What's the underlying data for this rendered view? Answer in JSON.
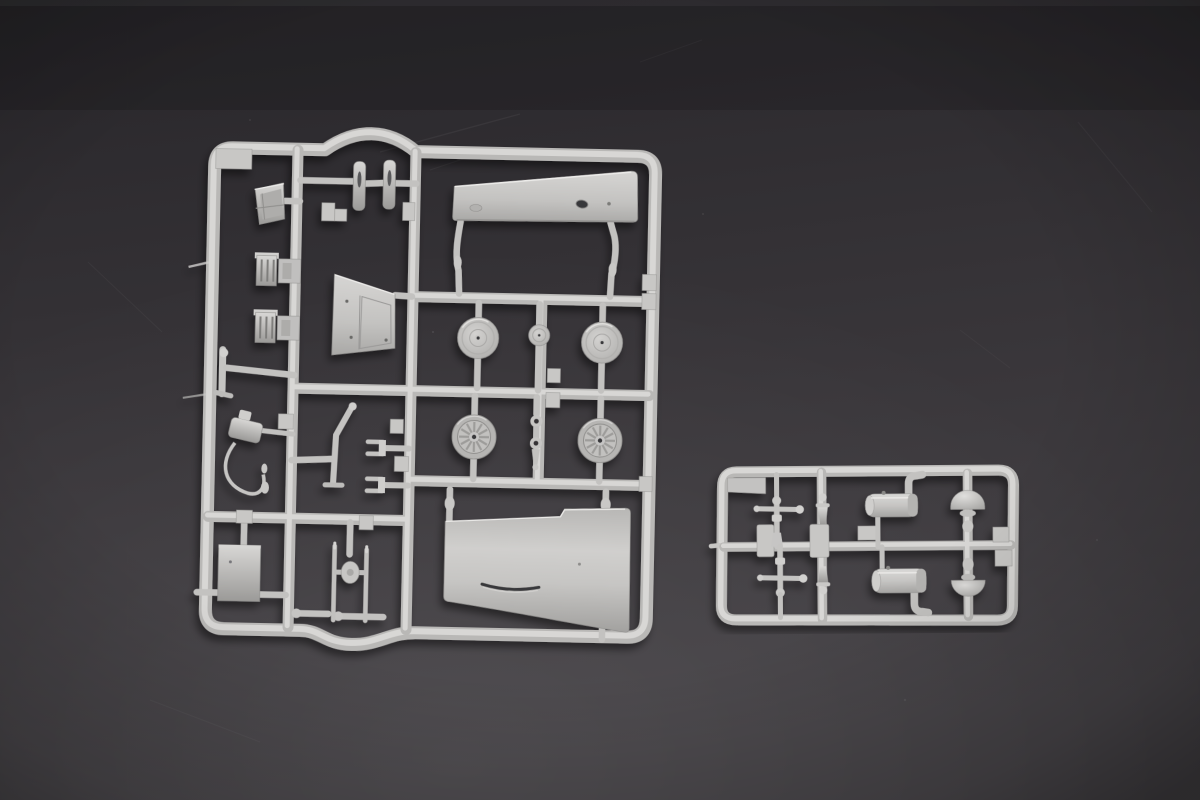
{
  "scene": {
    "description": "Overhead product photograph of two light-gray injection-molded plastic model kit sprues (parts trees) lying on a dark charcoal slate surface. The large left sprue holds two fuselage halves, four wheels, a tail wheel, a windscreen, brackets, struts and small fittings. The small right sprue holds control yokes, spindles, two exhaust cylinders and two dome-shaped parts.",
    "style": "product-photo",
    "background": "dark charcoal surface with faint scratches and soft vignette"
  },
  "colors": {
    "bg-top": "#28262a",
    "bg-bottom": "#454246",
    "plastic-base": "#c2c1bf",
    "plastic-light": "#d8d7d5",
    "plastic-highlight": "#ecebe9",
    "plastic-shadow": "#9b9a98",
    "rail-base": "#b9b8b6",
    "tab-fill": "#c8c7c5",
    "hole-dark": "#39383a"
  },
  "sprues": [
    {
      "id": "main-sprue",
      "position": "left",
      "parts": [
        "upper-fuselage-half",
        "lower-fuselage-half",
        "wheel-disc-left",
        "wheel-disc-right",
        "tail-wheel",
        "spoked-wheel-left",
        "spoked-wheel-right",
        "windscreen",
        "bracket-1",
        "bracket-2",
        "t-lever",
        "hand-pump-with-hose",
        "bulkhead-panel",
        "angled-strut",
        "fork-end-1",
        "fork-end-2",
        "chain-links",
        "equipment-box",
        "landing-gear-strut",
        "blade-1",
        "blade-2",
        "number-tabs"
      ]
    },
    {
      "id": "small-sprue",
      "position": "right",
      "parts": [
        "corner-plate",
        "control-yoke-1",
        "control-yoke-2",
        "spindle-1",
        "spindle-2",
        "exhaust-cylinder-1",
        "exhaust-cylinder-2",
        "dome-1",
        "dome-2",
        "number-tabs"
      ]
    }
  ]
}
